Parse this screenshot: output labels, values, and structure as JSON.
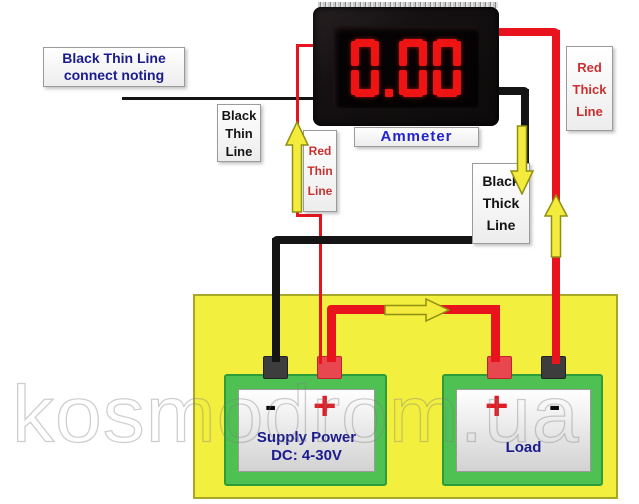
{
  "ammeter": {
    "value": "0.00",
    "label": "Ammeter"
  },
  "note_label": {
    "l1": "Black Thin Line",
    "l2": "connect noting"
  },
  "wire_labels": {
    "black_thin": {
      "l1": "Black",
      "l2": "Thin",
      "l3": "Line"
    },
    "red_thin": {
      "l1": "Red",
      "l2": "Thin",
      "l3": "Line"
    },
    "red_thick": {
      "l1": "Red",
      "l2": "Thick",
      "l3": "Line"
    },
    "black_thick": {
      "l1": "Black",
      "l2": "Thick",
      "l3": "Line"
    }
  },
  "supply": {
    "l1": "Supply Power",
    "l2": "DC: 4-30V",
    "neg": "-",
    "pos": "+"
  },
  "load": {
    "name": "Load",
    "pos": "+",
    "neg": "-"
  },
  "watermark": {
    "text": "kosmodrom.ua"
  },
  "icons": {
    "flow_arrow_up_red_thin": "arrow-up",
    "flow_arrow_down_black_thick": "arrow-down",
    "flow_arrow_up_red_thick": "arrow-up",
    "flow_arrow_right_supply_to_load": "arrow-right"
  },
  "colors": {
    "wire_red": "#e8131c",
    "wire_black": "#141414",
    "arrow_yellow": "#f4ec3c",
    "panel_yellow": "#f2ef3e",
    "device_green": "#4fc153",
    "display_red": "#ee1413",
    "text_navy": "#1b1b8e",
    "text_blue": "#2323cc",
    "text_red_label": "#c93030",
    "terminal_red": "#e84750",
    "terminal_dark": "#3d3d3d"
  }
}
